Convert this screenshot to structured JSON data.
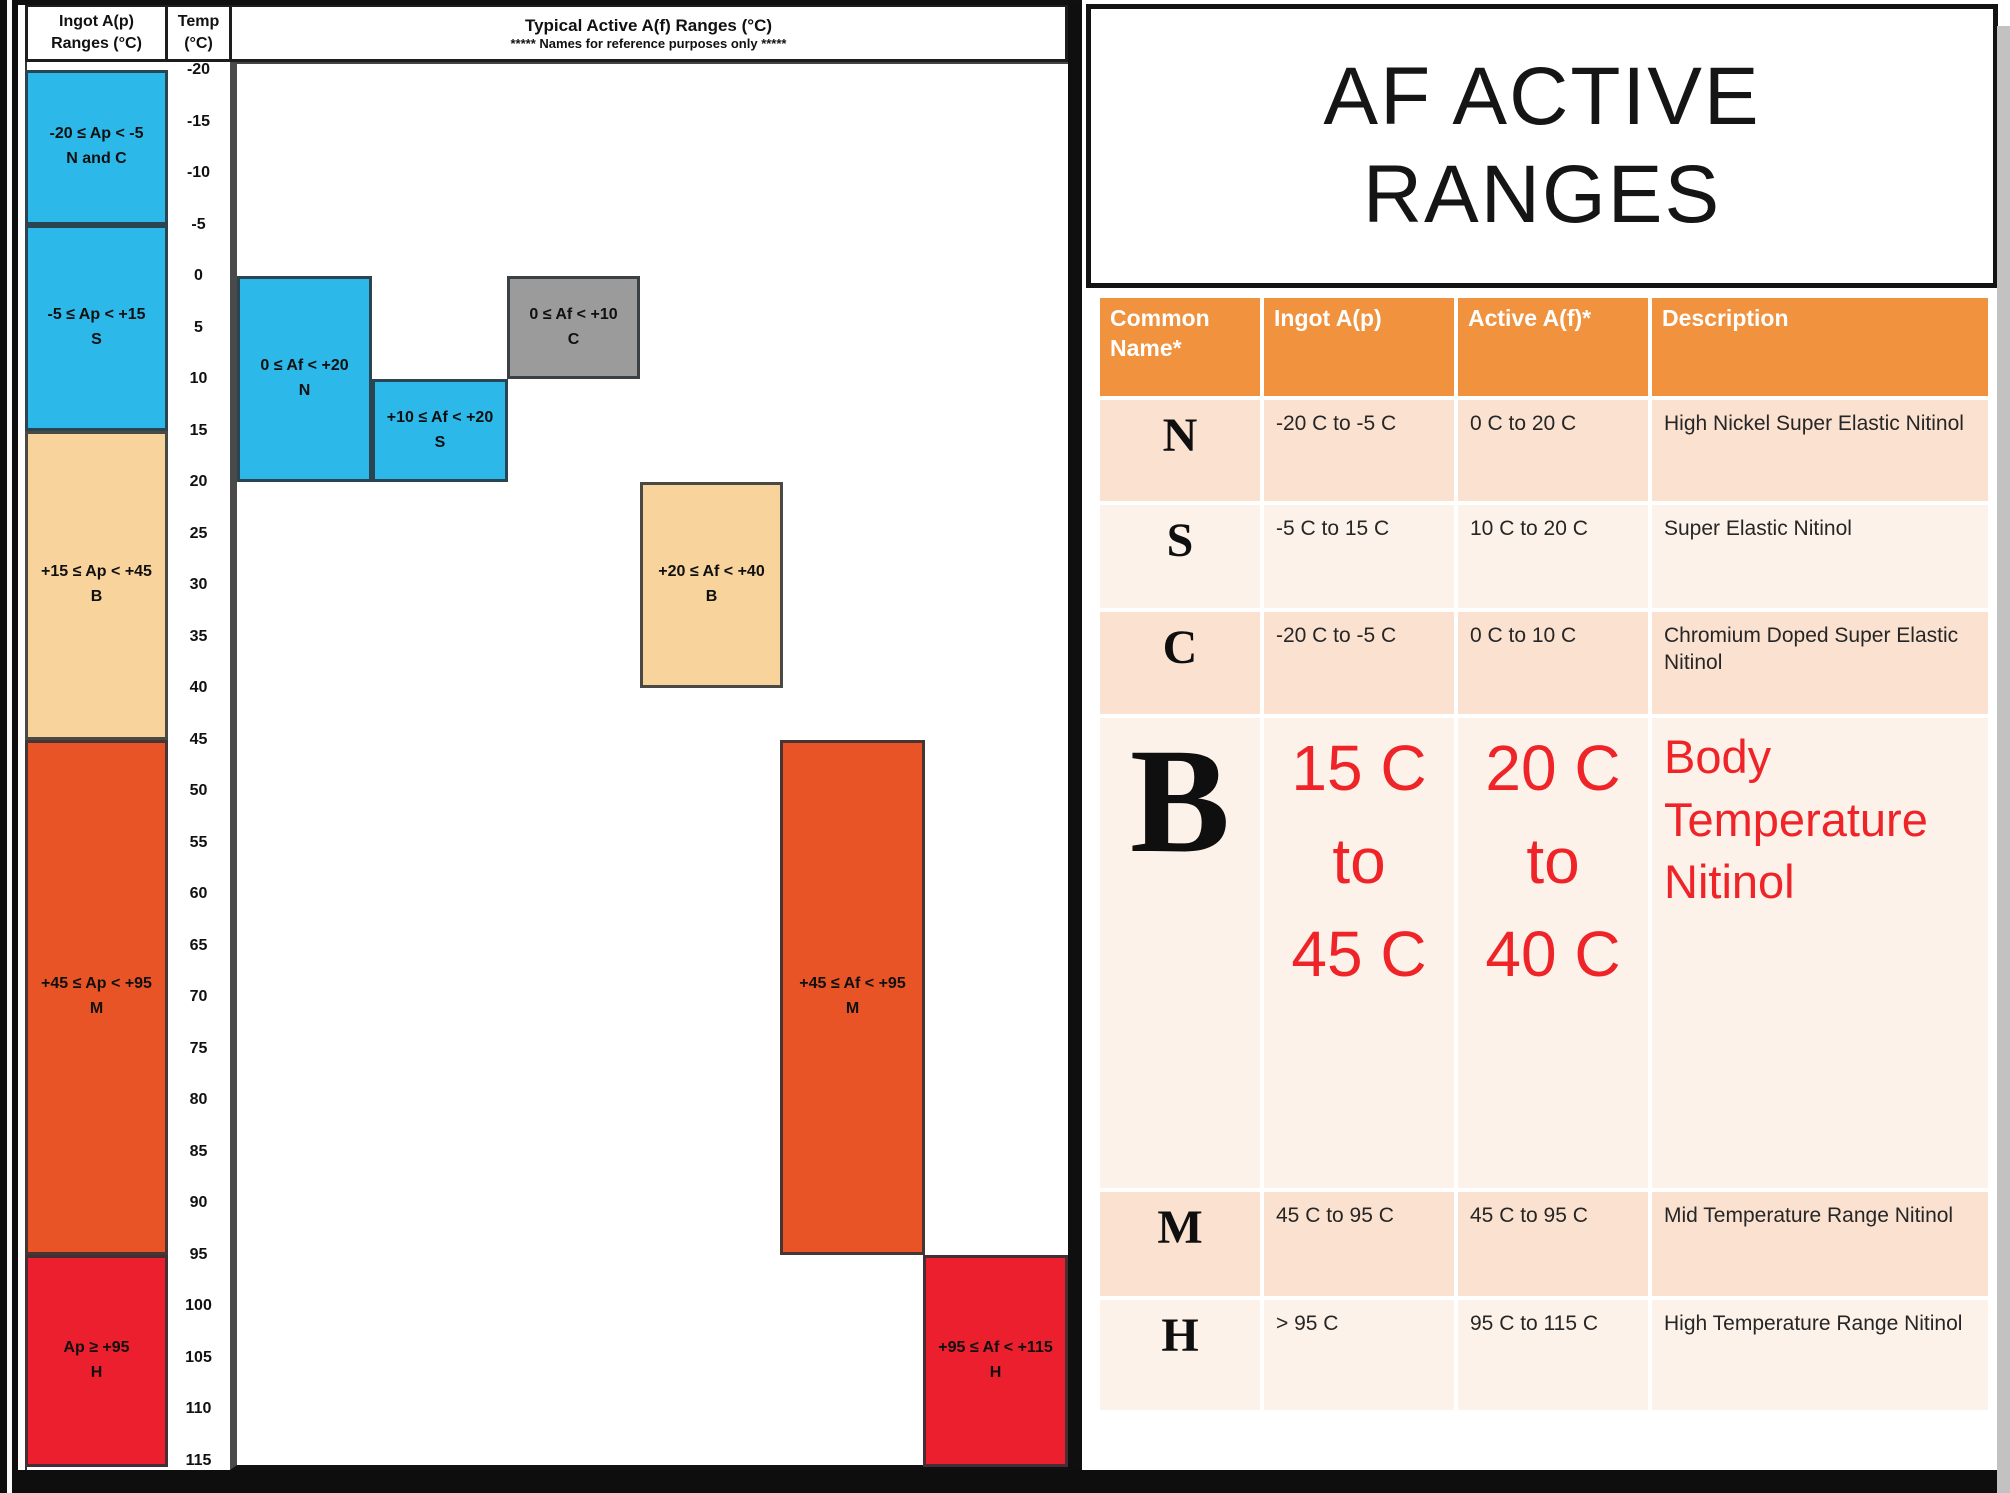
{
  "page": {
    "title_lines": [
      "AF ACTIVE",
      "RANGES"
    ]
  },
  "left_chart": {
    "ingot_header_lines": [
      "Ingot A(p)",
      "Ranges (°C)"
    ],
    "temp_header_lines": [
      "Temp",
      "(°C)"
    ],
    "chart_header_lines": [
      "Typical Active A(f) Ranges (°C)",
      "***** Names for reference purposes only *****"
    ],
    "temp_scale": {
      "min": -20,
      "max": 115,
      "step": 5,
      "unit": "°C"
    },
    "ingot_boxes": [
      {
        "range_label": "-20 ≤ Ap < -5",
        "name_label": "N and C",
        "t_start": -20,
        "t_end": -5,
        "color": "#2CB9E9"
      },
      {
        "range_label": "-5 ≤ Ap < +15",
        "name_label": "S",
        "t_start": -5,
        "t_end": 15,
        "color": "#2CB9E9"
      },
      {
        "range_label": "+15 ≤ Ap < +45",
        "name_label": "B",
        "t_start": 15,
        "t_end": 45,
        "color": "#F8D49C"
      },
      {
        "range_label": "+45 ≤ Ap < +95",
        "name_label": "M",
        "t_start": 45,
        "t_end": 95,
        "color": "#E95426"
      },
      {
        "range_label": "Ap ≥ +95",
        "name_label": "H",
        "t_start": 95,
        "t_end": 116,
        "color": "#EB1F2D"
      }
    ],
    "af_boxes": [
      {
        "range_label": "0 ≤ Af < +20",
        "name_label": "N",
        "t_start": 0,
        "t_end": 20,
        "x": 237,
        "w": 135,
        "color": "#2CB9E9"
      },
      {
        "range_label": "+10 ≤ Af < +20",
        "name_label": "S",
        "t_start": 10,
        "t_end": 20,
        "x": 372,
        "w": 136,
        "color": "#2CB9E9"
      },
      {
        "range_label": "0 ≤ Af < +10",
        "name_label": "C",
        "t_start": 0,
        "t_end": 10,
        "x": 507,
        "w": 133,
        "color": "#9B9B9B"
      },
      {
        "range_label": "+20 ≤ Af < +40",
        "name_label": "B",
        "t_start": 20,
        "t_end": 40,
        "x": 640,
        "w": 143,
        "color": "#F8D49C"
      },
      {
        "range_label": "+45 ≤ Af < +95",
        "name_label": "M",
        "t_start": 45,
        "t_end": 95,
        "x": 780,
        "w": 145,
        "color": "#E95426"
      },
      {
        "range_label": "+95 ≤ Af < +115",
        "name_label": "H",
        "t_start": 95,
        "t_end": 116,
        "x": 923,
        "w": 145,
        "color": "#EB1F2D"
      }
    ]
  },
  "table": {
    "headers": [
      "Common Name*",
      "Ingot A(p)",
      "Active A(f)*",
      "Description"
    ],
    "rows": [
      {
        "name": "N",
        "ingot": "-20 C to -5 C",
        "active": "0 C to 20 C",
        "description": "High Nickel Super Elastic Nitinol",
        "big": false
      },
      {
        "name": "S",
        "ingot": "-5 C to 15 C",
        "active": "10 C to 20 C",
        "description": "Super Elastic Nitinol",
        "big": false
      },
      {
        "name": "C",
        "ingot": "-20 C to -5 C",
        "active": "0 C to 10 C",
        "description": "Chromium Doped Super Elastic Nitinol",
        "big": false
      },
      {
        "name": "B",
        "ingot": [
          "15 C",
          "to",
          "45 C"
        ],
        "active": [
          "20 C",
          "to",
          "40 C"
        ],
        "description": "Body Temperature Nitinol",
        "big": true
      },
      {
        "name": "M",
        "ingot": "45 C to 95 C",
        "active": "45 C to 95 C",
        "description": "Mid Temperature Range Nitinol",
        "big": false
      },
      {
        "name": "H",
        "ingot": "> 95 C",
        "active": "95 C to 115 C",
        "description": "High Temperature Range Nitinol",
        "big": false
      }
    ]
  },
  "colors": {
    "blue": "#2CB9E9",
    "tan": "#F8D49C",
    "orange": "#E95426",
    "red": "#EB1F2D",
    "gray": "#9B9B9B",
    "table_header_orange": "#F0923E",
    "row_shade_dark": "#FAE1D0",
    "row_shade_light": "#FDF2E9",
    "red_text": "#EE2428"
  },
  "chart_data": {
    "type": "bar",
    "title": "Typical Active A(f) Ranges (°C)",
    "subtitle": "***** Names for reference purposes only *****",
    "ylabel": "Temp (°C)",
    "ylim": [
      -20,
      115
    ],
    "grid": false,
    "legend_position": "none",
    "categories": [
      "N",
      "S",
      "C",
      "B",
      "M",
      "H"
    ],
    "series": [
      {
        "name": "Ingot A(p) range (°C)",
        "values": [
          [
            -20,
            -5
          ],
          [
            -5,
            15
          ],
          [
            -20,
            -5
          ],
          [
            15,
            45
          ],
          [
            45,
            95
          ],
          [
            95,
            115
          ]
        ]
      },
      {
        "name": "Active A(f) range (°C)",
        "values": [
          [
            0,
            20
          ],
          [
            10,
            20
          ],
          [
            0,
            10
          ],
          [
            20,
            40
          ],
          [
            45,
            95
          ],
          [
            95,
            115
          ]
        ]
      }
    ]
  }
}
